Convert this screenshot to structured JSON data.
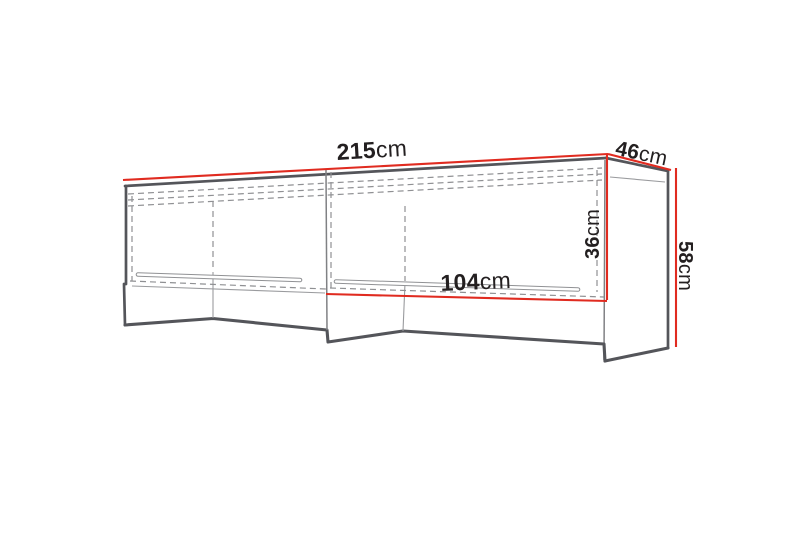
{
  "measurements": {
    "width": {
      "value": "215",
      "unit": "cm"
    },
    "depth": {
      "value": "46",
      "unit": "cm"
    },
    "inner_height": {
      "value": "36",
      "unit": "cm"
    },
    "height": {
      "value": "58",
      "unit": "cm"
    },
    "inner_width": {
      "value": "104",
      "unit": "cm"
    }
  },
  "colors": {
    "dimension_red": "#e02b20",
    "edge_gray": "#54555a",
    "hidden_gray": "#8f9093",
    "text_black": "#231f20",
    "background": "#ffffff"
  }
}
